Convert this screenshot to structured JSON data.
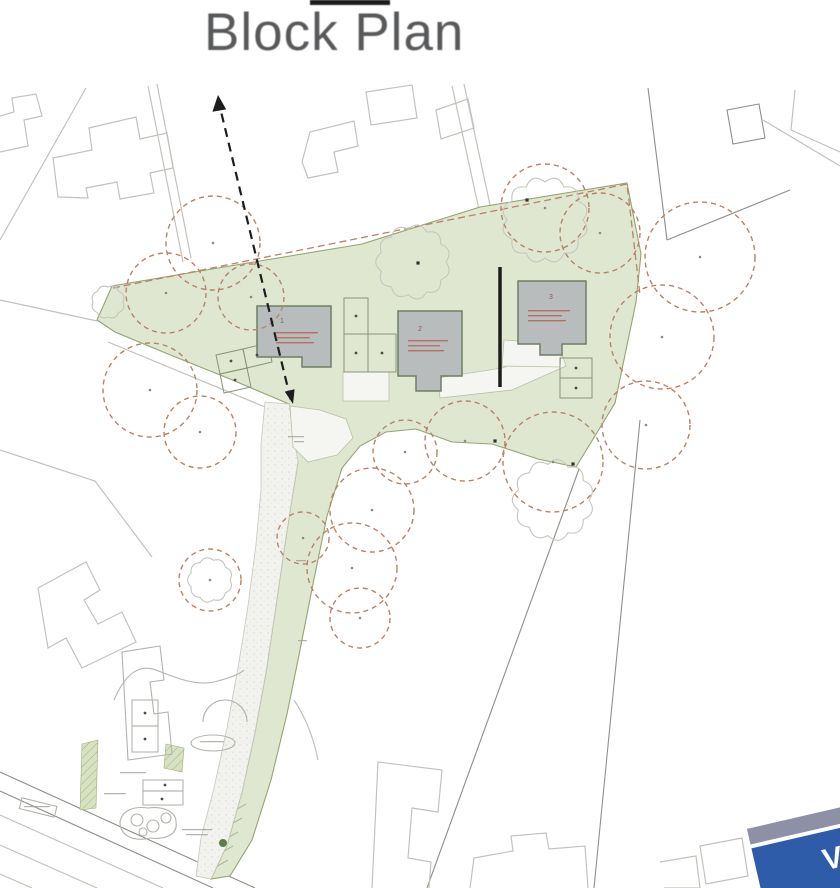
{
  "header": {
    "title": "Block Plan"
  },
  "colors": {
    "green_fill": "#e0e7d1",
    "green_stroke": "#95a472",
    "strip_hatch": "#9db07e",
    "tree": "#b5846a",
    "building_fill": "#b9bcbc",
    "building_stroke": "#6f7f66",
    "line": "#c2c2bd",
    "line_dark": "#8f8f8a",
    "accent_red": "#b35a50",
    "logo_blue": "#2e5ca9",
    "logo_band": "#8e90a6",
    "title_gray": "#58595b",
    "black": "#1d1d1d"
  },
  "plan": {
    "plots": [
      {
        "number": "1"
      },
      {
        "number": "2"
      },
      {
        "number": "3"
      }
    ],
    "logo": {
      "letter": "V"
    },
    "trees": [
      {
        "cx": 213,
        "cy": 243,
        "r": 47
      },
      {
        "cx": 166,
        "cy": 293,
        "r": 40
      },
      {
        "cx": 150,
        "cy": 390,
        "r": 47
      },
      {
        "cx": 200,
        "cy": 432,
        "r": 36
      },
      {
        "cx": 251,
        "cy": 297,
        "r": 33
      },
      {
        "cx": 545,
        "cy": 208,
        "r": 44
      },
      {
        "cx": 600,
        "cy": 233,
        "r": 40
      },
      {
        "cx": 700,
        "cy": 257,
        "r": 55
      },
      {
        "cx": 662,
        "cy": 337,
        "r": 52
      },
      {
        "cx": 646,
        "cy": 425,
        "r": 44
      },
      {
        "cx": 553,
        "cy": 462,
        "r": 50
      },
      {
        "cx": 465,
        "cy": 441,
        "r": 40
      },
      {
        "cx": 405,
        "cy": 452,
        "r": 32
      },
      {
        "cx": 372,
        "cy": 510,
        "r": 42
      },
      {
        "cx": 352,
        "cy": 568,
        "r": 45
      },
      {
        "cx": 360,
        "cy": 618,
        "r": 30
      },
      {
        "cx": 303,
        "cy": 538,
        "r": 26
      },
      {
        "cx": 210,
        "cy": 580,
        "r": 31
      }
    ],
    "clouds": [
      {
        "cx": 413,
        "cy": 262,
        "r": 33,
        "n": 11
      },
      {
        "cx": 545,
        "cy": 220,
        "r": 38,
        "n": 12
      },
      {
        "cx": 108,
        "cy": 302,
        "r": 15,
        "n": 8
      },
      {
        "cx": 210,
        "cy": 580,
        "r": 20,
        "n": 9
      },
      {
        "cx": 553,
        "cy": 500,
        "r": 36,
        "n": 11
      }
    ],
    "site_dots": [
      [
        527,
        200
      ],
      [
        418,
        263
      ],
      [
        573,
        464
      ],
      [
        495,
        441
      ]
    ],
    "small_dots": [
      [
        356,
        316
      ],
      [
        356,
        353
      ],
      [
        382,
        353
      ],
      [
        231,
        361
      ],
      [
        235,
        380
      ],
      [
        257,
        355
      ],
      [
        576,
        368
      ],
      [
        576,
        388
      ],
      [
        145,
        713
      ],
      [
        145,
        739
      ],
      [
        165,
        785
      ],
      [
        162,
        799
      ]
    ],
    "green_tree_dot": [
      223,
      843
    ],
    "smudges_gray": [
      [
        120,
        772,
        26
      ],
      [
        104,
        793,
        22
      ],
      [
        182,
        829,
        30
      ],
      [
        186,
        834,
        22
      ],
      [
        200,
        741,
        24
      ],
      [
        288,
        436,
        16
      ],
      [
        294,
        441,
        10
      ],
      [
        24,
        806,
        26
      ],
      [
        296,
        560,
        10
      ],
      [
        298,
        640,
        9
      ]
    ],
    "smudges_red": [
      [
        276,
        332,
        42
      ],
      [
        276,
        337,
        34
      ],
      [
        276,
        342,
        38
      ],
      [
        408,
        340,
        40
      ],
      [
        408,
        345,
        32
      ],
      [
        408,
        350,
        36
      ],
      [
        528,
        310,
        42
      ],
      [
        528,
        315,
        34
      ],
      [
        528,
        320,
        38
      ]
    ],
    "hatch_lines": [
      [
        232,
        812,
        246,
        804
      ],
      [
        228,
        826,
        242,
        818
      ],
      [
        224,
        840,
        238,
        832
      ],
      [
        219,
        854,
        233,
        846
      ],
      [
        214,
        868,
        228,
        860
      ]
    ]
  }
}
